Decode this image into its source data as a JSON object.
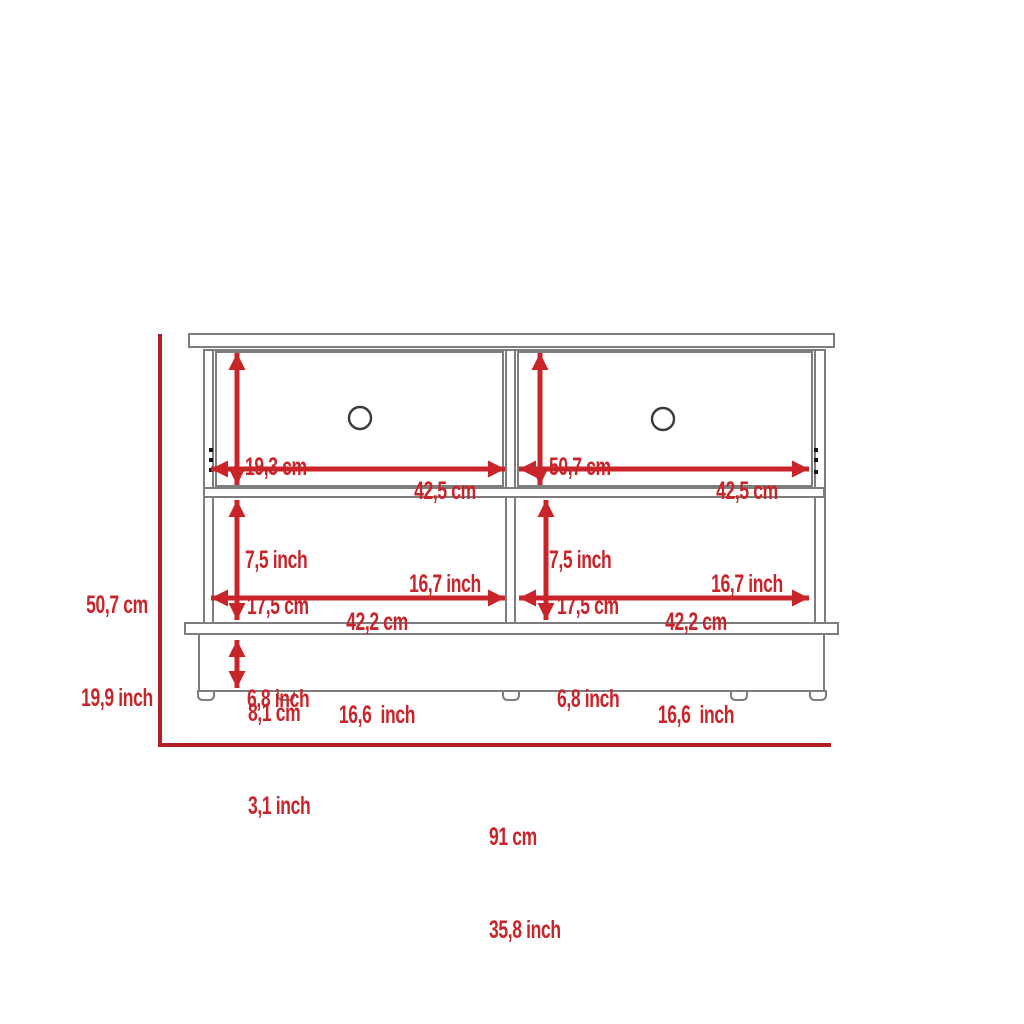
{
  "colors": {
    "dimension_red": "#c8242a",
    "guide_red": "#ae2026",
    "outline_gray": "#7d7d7d",
    "handle_gray": "#3a3a3a",
    "background": "#ffffff"
  },
  "overall": {
    "height_cm": "50,7 cm",
    "height_inch": "19,9 inch",
    "width_cm": "91 cm",
    "width_inch": "35,8 inch"
  },
  "top_left_drawer": {
    "height_cm": "19,3 cm",
    "height_inch": "7,5 inch",
    "width_cm": "42,5 cm",
    "width_inch": "16,7 inch"
  },
  "top_right_drawer": {
    "height_cm": "50,7 cm",
    "height_inch": "7,5 inch",
    "width_cm": "42,5 cm",
    "width_inch": "16,7 inch"
  },
  "bottom_left_shelf": {
    "height_cm": "17,5 cm",
    "height_inch": "6,8 inch",
    "width_cm": "42,2 cm",
    "width_inch": "16,6  inch"
  },
  "bottom_right_shelf": {
    "height_cm": "17,5 cm",
    "height_inch": "6,8 inch",
    "width_cm": "42,2 cm",
    "width_inch": "16,6  inch"
  },
  "base": {
    "height_cm": "8,1 cm",
    "height_inch": "3,1 inch"
  }
}
